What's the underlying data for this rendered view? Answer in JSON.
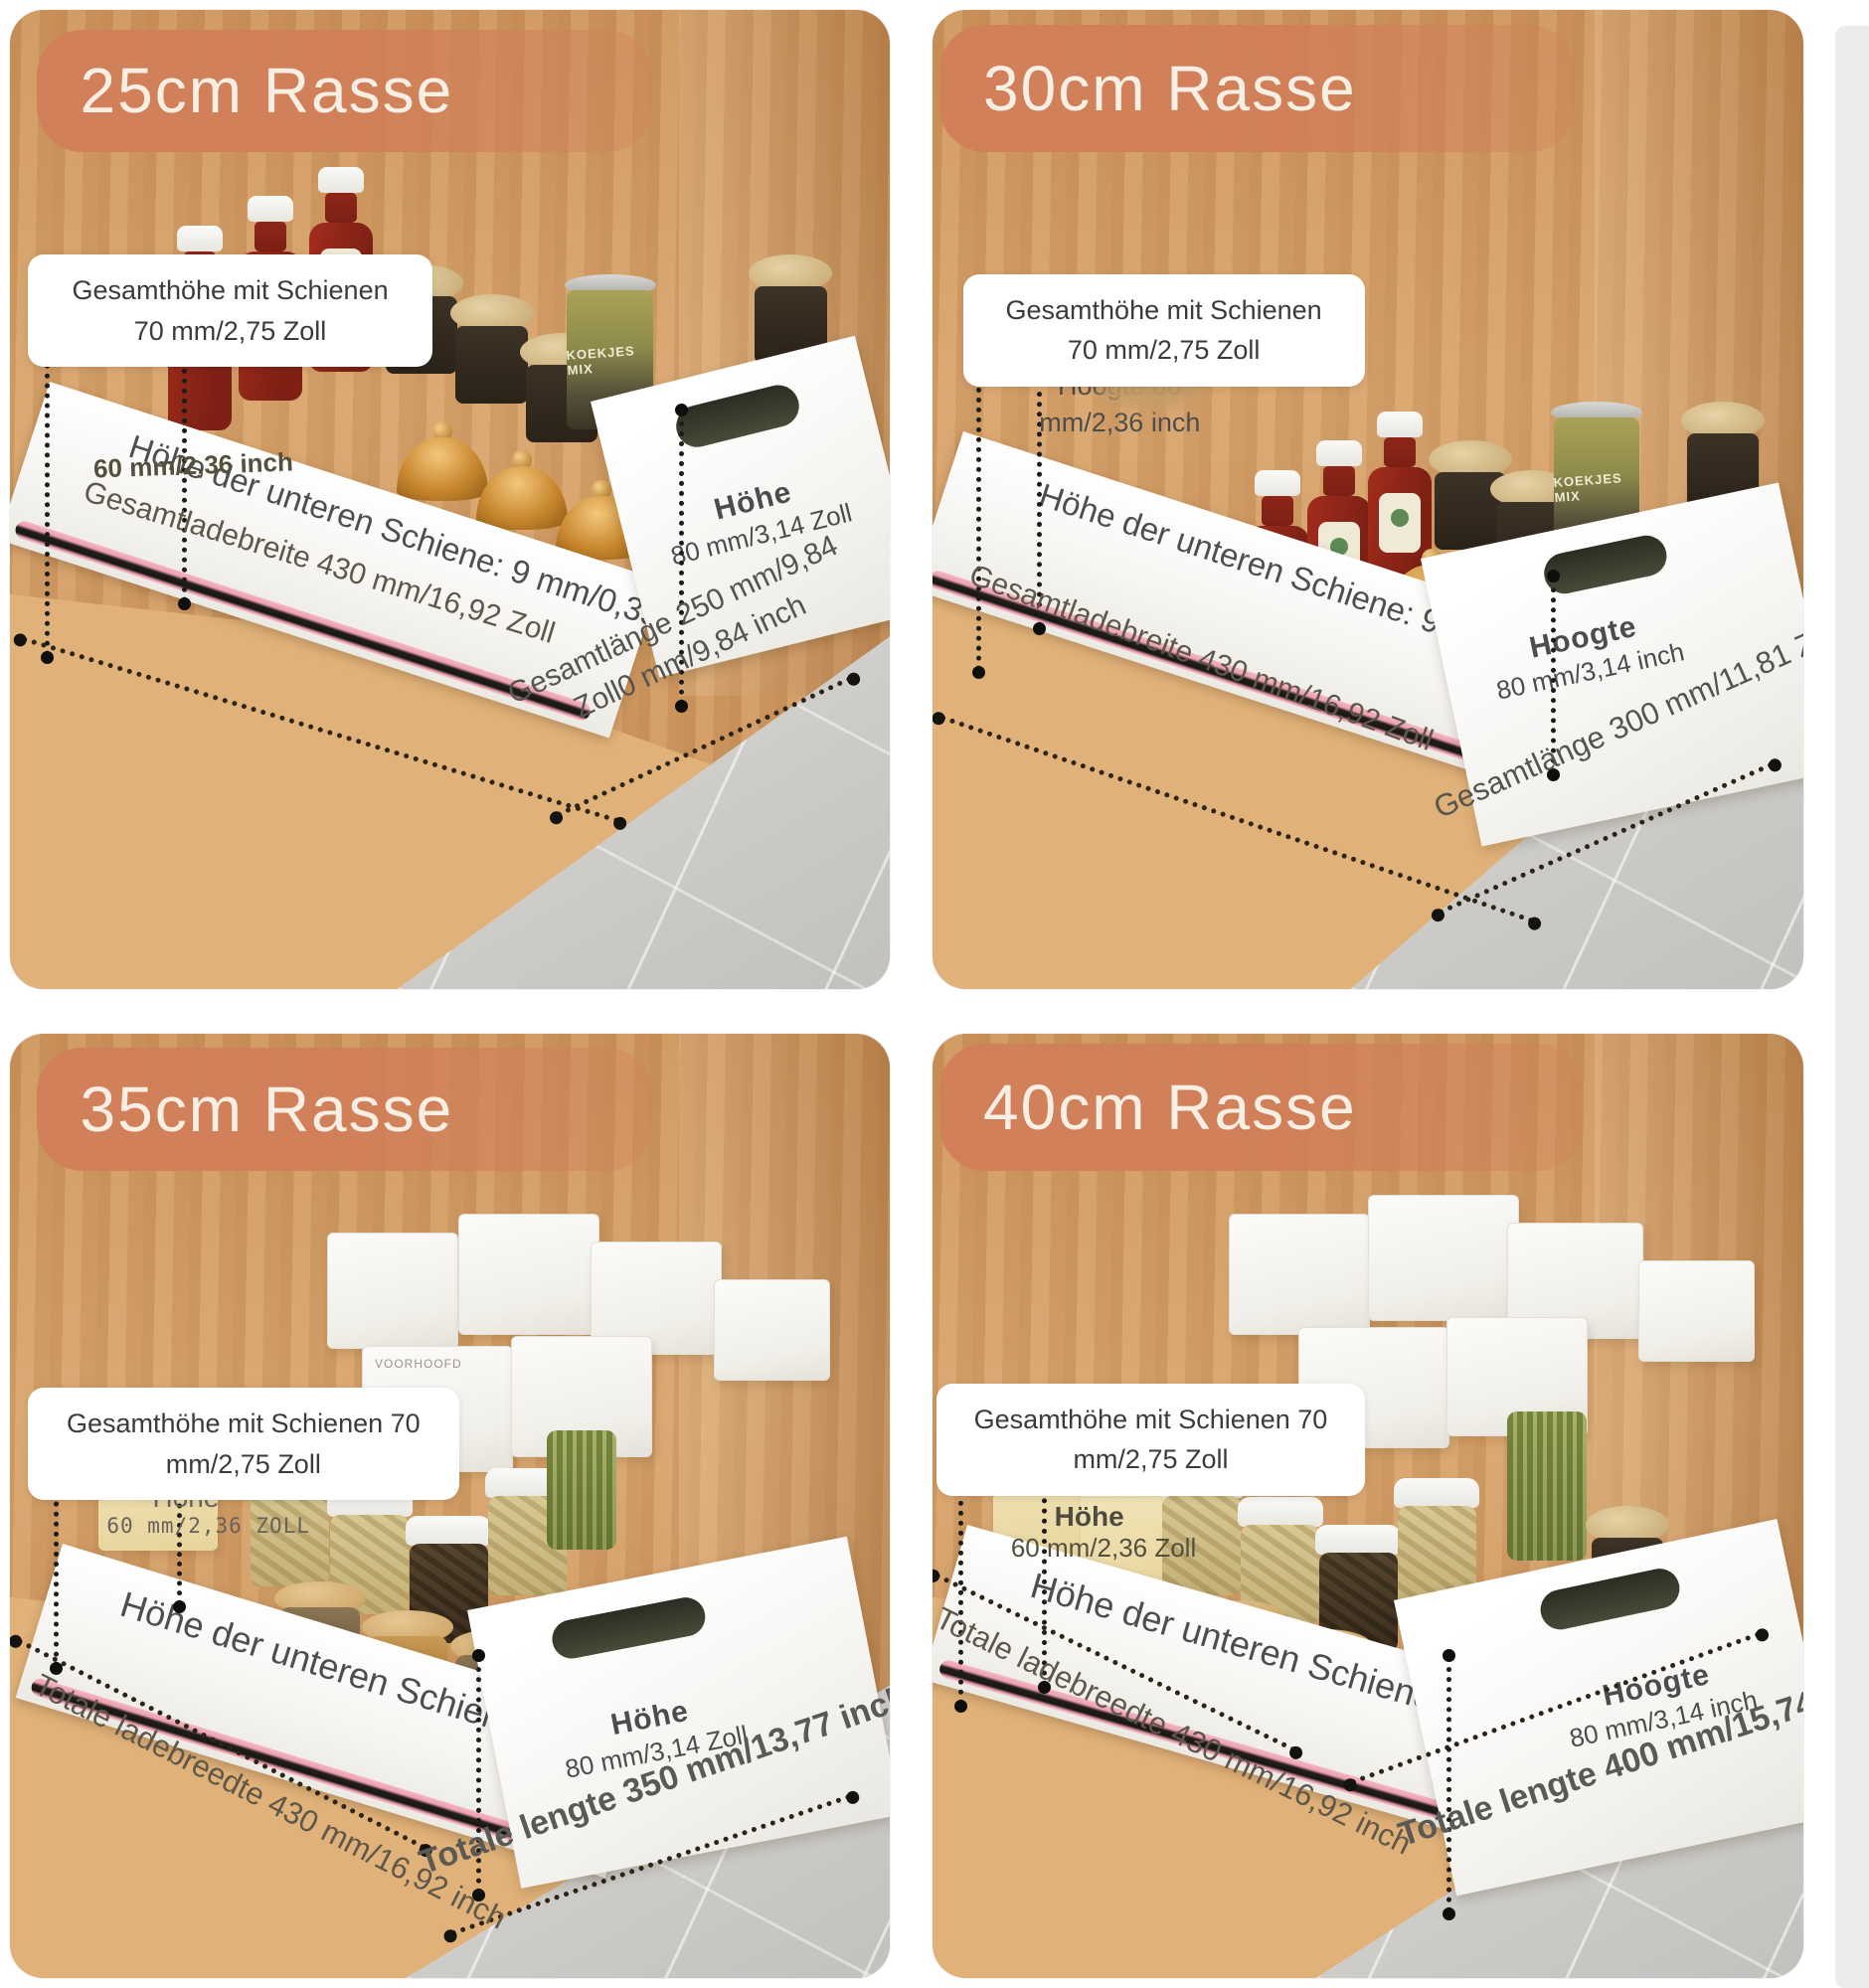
{
  "colors": {
    "banner": "#d17f59",
    "wood": "#d7a36c",
    "rail_pink": "#f5b6c3",
    "tile": "#cbcac7",
    "label_text": "#4c4c4c"
  },
  "panels": [
    {
      "title": "25cm Rasse",
      "overall": {
        "line1": "Gesamthöhe mit Schienen",
        "line2": "70 mm/2,75 Zoll"
      },
      "inner": {
        "line1": "60 mm/2,36 inch",
        "line2": ""
      },
      "rail": "Höhe der unteren Schiene: 9 mm/0,35 Zoll",
      "width": "Gesamtladebreite 430 mm/16,92 Zoll",
      "front": {
        "line1": "Höhe",
        "line2": "80 mm/3,14 Zoll"
      },
      "length": {
        "line1": "Gesamtlänge 250 mm/9,84",
        "line2": "Zoll0 mm/9,84 inch"
      },
      "photo_text": "KOEKJES MIX"
    },
    {
      "title": "30cm Rasse",
      "overall": {
        "line1": "Gesamthöhe mit Schienen",
        "line2": "70 mm/2,75 Zoll"
      },
      "inner": {
        "line1": "Hoogte 60",
        "line2": "mm/2,36 inch"
      },
      "rail": "Höhe der unteren Schiene: 9 mm/0,35 Zoll",
      "width": "Gesamtladebreite 430 mm/16,92 Zoll",
      "front": {
        "line1": "Hoogte",
        "line2": "80 mm/3,14 inch"
      },
      "length": {
        "line1": "Gesamtlänge 300 mm/11,81 Zoll",
        "line2": ""
      },
      "photo_text": "KOEKJES MIX"
    },
    {
      "title": "35cm Rasse",
      "overall": {
        "line1": "Gesamthöhe mit Schienen 70",
        "line2": "mm/2,75 Zoll"
      },
      "inner": {
        "line1": "Höhe",
        "line2": "60 mm/2,36 ZOLL"
      },
      "rail": "Höhe der unteren Schiene: 9 mm/0,35 Zoll",
      "width": "Totale ladebreedte 430 mm/16,92 inch",
      "front": {
        "line1": "Höhe",
        "line2": "80 mm/3,14 Zoll"
      },
      "length": {
        "line1": "Totale lengte 350 mm/13,77 inch",
        "line2": ""
      },
      "photo_text": "VOORHOOFD"
    },
    {
      "title": "40cm Rasse",
      "overall": {
        "line1": "Gesamthöhe mit Schienen 70",
        "line2": "mm/2,75 Zoll"
      },
      "inner": {
        "line1": "Höhe",
        "line2": "60 mm/2,36 Zoll"
      },
      "rail": "Höhe der unteren Schiene: 9 mm/0,35 Zoll",
      "width": "Totale ladebreedte 430 mm/16,92 inch",
      "front": {
        "line1": "Hoogte",
        "line2": "80 mm/3,14 inch"
      },
      "length": {
        "line1": "Totale lengte 400 mm/15,74 inch",
        "line2": ""
      },
      "photo_text": ""
    }
  ]
}
